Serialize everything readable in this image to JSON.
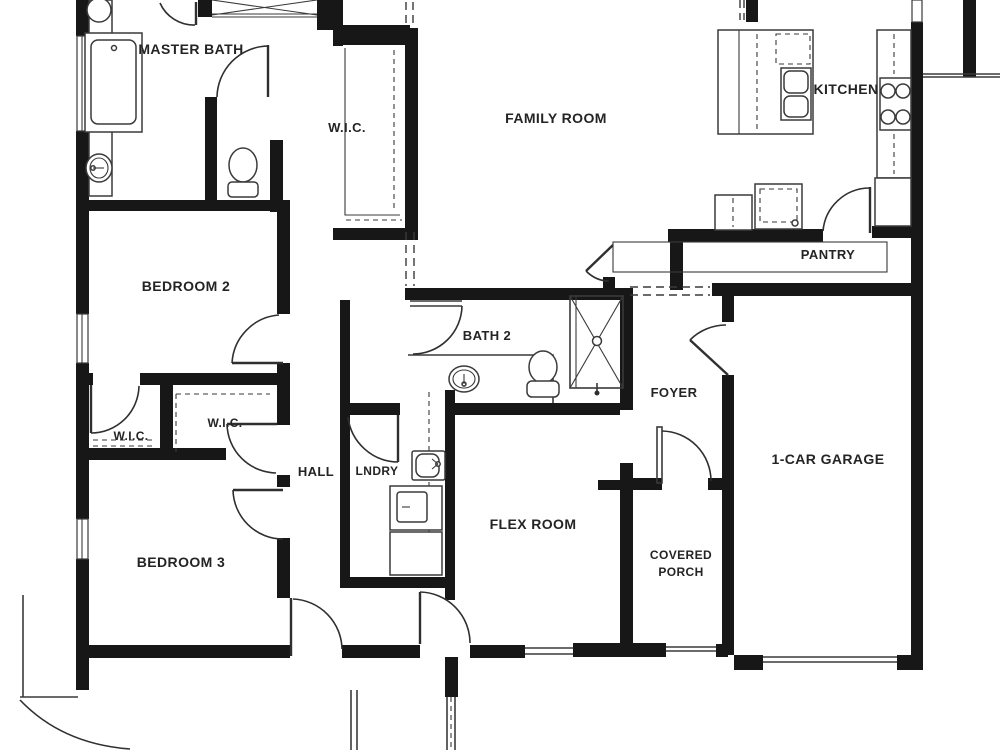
{
  "rooms": {
    "master_bath": "MASTER BATH",
    "wic_master": "W.I.C.",
    "family_room": "FAMILY ROOM",
    "kitchen": "KITCHEN",
    "pantry": "PANTRY",
    "bedroom2": "BEDROOM 2",
    "bath2": "BATH 2",
    "foyer": "FOYER",
    "wic_left": "W.I.C.",
    "wic_right": "W.I.C.",
    "hall": "HALL",
    "laundry": "LNDRY",
    "flex_room": "FLEX ROOM",
    "garage": "1-CAR GARAGE",
    "bedroom3": "BEDROOM 3",
    "covered_porch_line1": "COVERED",
    "covered_porch_line2": "PORCH"
  },
  "colors": {
    "wall": "#171717",
    "line": "#3a3a3a",
    "label": "#242424",
    "background": "#ffffff"
  }
}
